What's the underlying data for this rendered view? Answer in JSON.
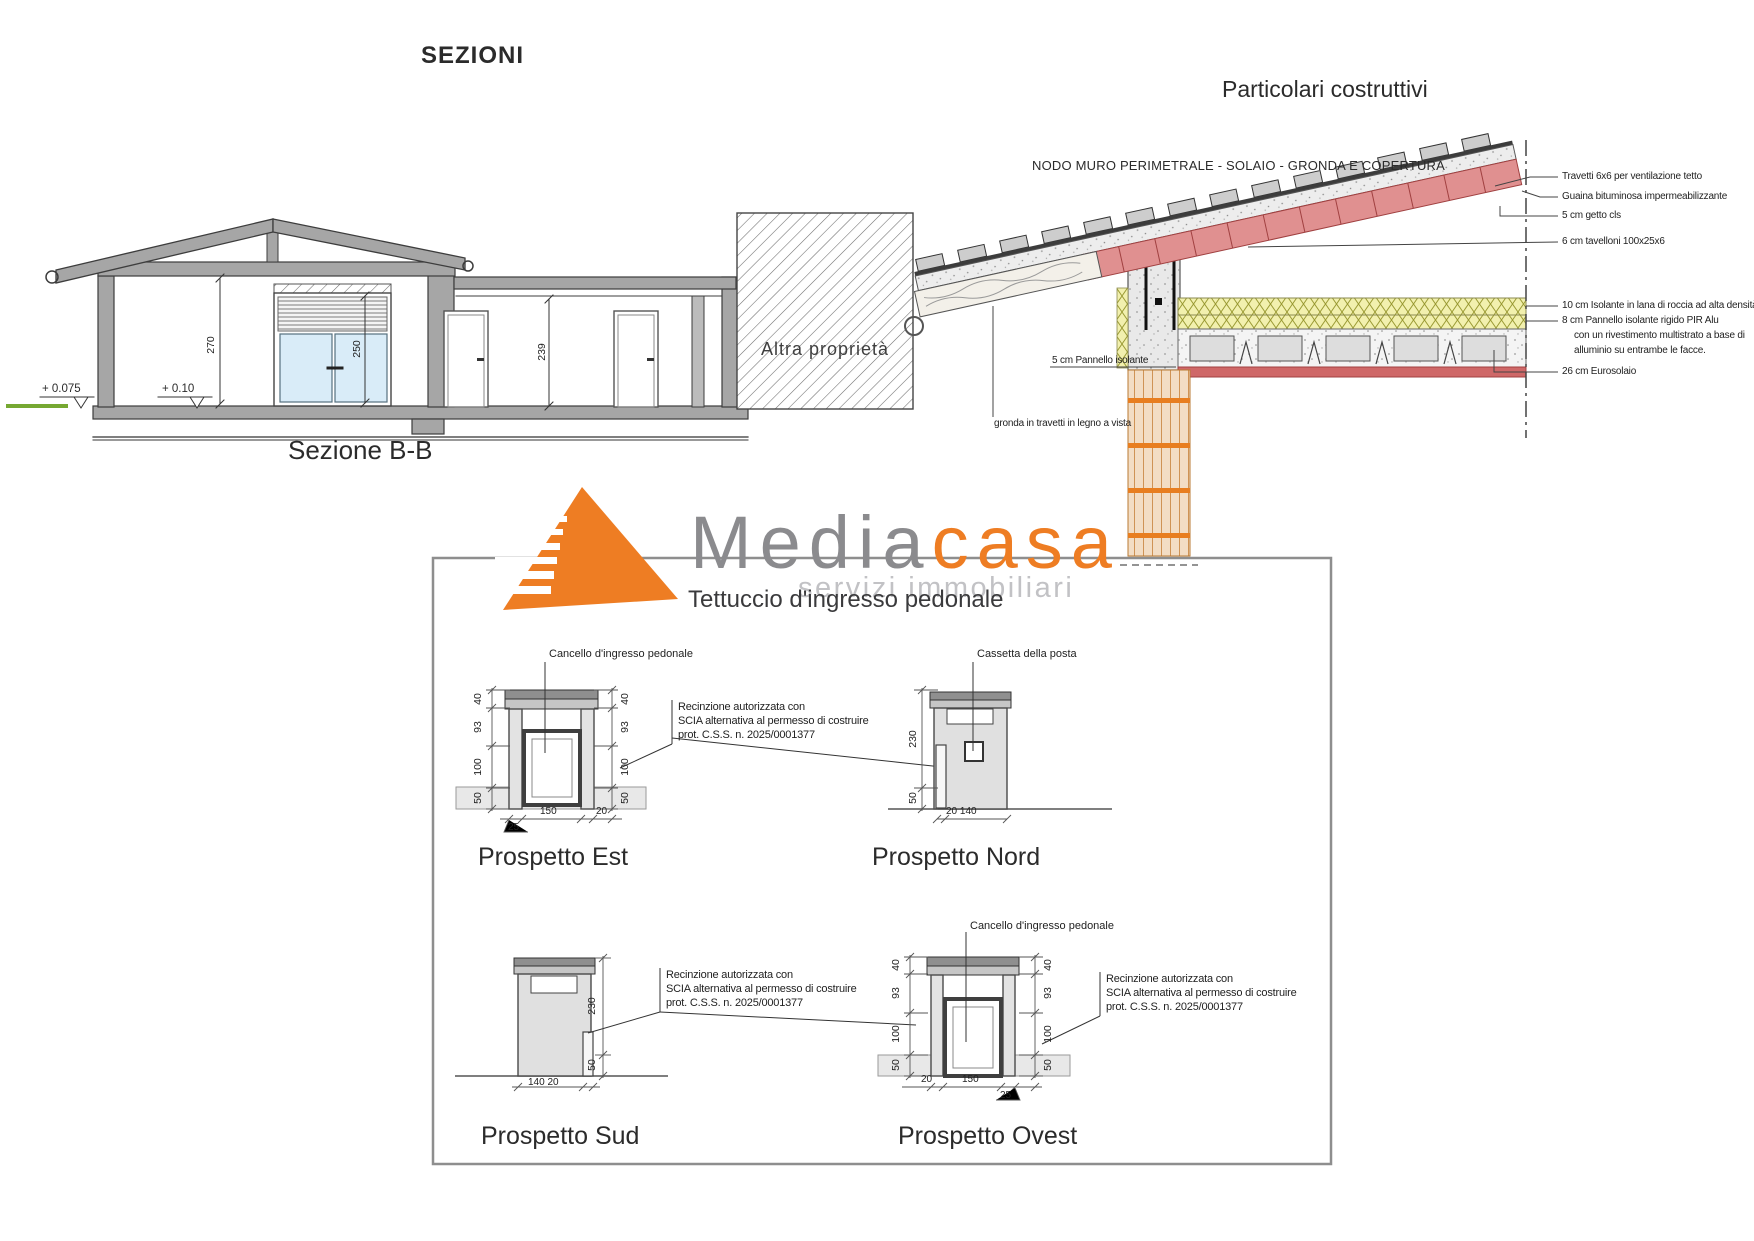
{
  "page": {
    "sezioni_title": "SEZIONI",
    "particolari_title": "Particolari costruttivi"
  },
  "sezione": {
    "caption": "Sezione  B-B",
    "altra_proprieta": "Altra proprietà",
    "level_left": "+ 0.075",
    "level_right": "+ 0.10",
    "dim_height_main": "270",
    "dim_window": "250",
    "dim_height_low": "239"
  },
  "detail": {
    "title": "NODO MURO PERIMETRALE - SOLAIO - GRONDA E COPERTURA",
    "labels": {
      "travetti": "Travetti 6x6 per ventilazione tetto",
      "guaina": "Guaina bituminosa impermeabilizzante",
      "getto": "5 cm getto cls",
      "tavelloni": "6 cm tavelloni 100x25x6",
      "lana": "10 cm Isolante in lana di roccia ad alta densità",
      "pir1": "8 cm Pannello isolante rigido PIR Alu",
      "pir2": "con un rivestimento multistrato a base di",
      "pir3": "alluminio su entrambe le facce.",
      "eurosolaio": "26 cm Eurosolaio",
      "pannello": "5 cm Pannello isolante",
      "gronda": "gronda in travetti in legno a vista"
    }
  },
  "logo": {
    "media": "Media",
    "casa": "casa",
    "tagline": "servizi immobiliari"
  },
  "tettuccio": {
    "title": "Tettuccio d'ingresso pedonale",
    "cancello_label": "Cancello d'ingresso pedonale",
    "cassetta_label": "Cassetta della posta",
    "recinzione1": "Recinzione autorizzata con",
    "recinzione2": "SCIA alternativa al permesso di costruire",
    "recinzione3": "prot. C.S.S. n. 2025/0001377",
    "est": {
      "title": "Prospetto Est",
      "dims_v": [
        "40",
        "93",
        "100",
        "50"
      ],
      "dim_150": "150",
      "dim_20": "20",
      "dim_25": "25"
    },
    "nord": {
      "title": "Prospetto Nord",
      "dim_230": "230",
      "dim_50": "50",
      "dim_bottom": "20  140"
    },
    "sud": {
      "title": "Prospetto Sud",
      "dim_230": "230",
      "dim_50": "50",
      "dim_bottom": "140  20"
    },
    "ovest": {
      "title": "Prospetto Ovest",
      "dims_v": [
        "40",
        "93",
        "100",
        "50"
      ],
      "dim_150": "150",
      "dim_20": "20",
      "dim_25": "25"
    }
  }
}
